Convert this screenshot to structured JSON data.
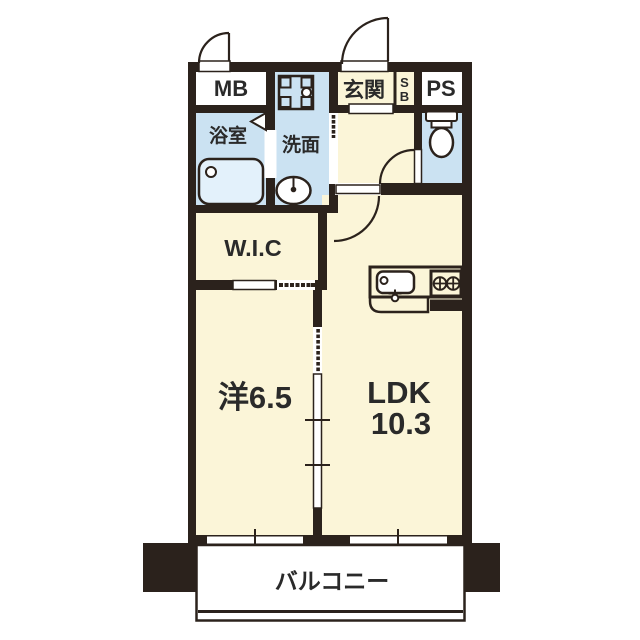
{
  "colors": {
    "wall": "#2b221c",
    "room": "#fbf5d8",
    "water": "#cbe2f2",
    "white": "#ffffff",
    "text": "#2a2a2a",
    "fixture_blue": "#e3f1fb"
  },
  "rooms": {
    "meter_box": {
      "label": "MB"
    },
    "entrance": {
      "label": "玄関"
    },
    "shoe_box": {
      "letters": [
        "S",
        "B"
      ]
    },
    "pipe_space": {
      "label": "PS"
    },
    "bathroom": {
      "label": "浴室"
    },
    "washroom": {
      "label": "洗面"
    },
    "walk_in_closet": {
      "label": "W.I.C"
    },
    "western_room": {
      "label": "洋6.5"
    },
    "ldk": {
      "label": "LDK",
      "size": "10.3"
    },
    "balcony": {
      "label": "バルコニー"
    }
  }
}
